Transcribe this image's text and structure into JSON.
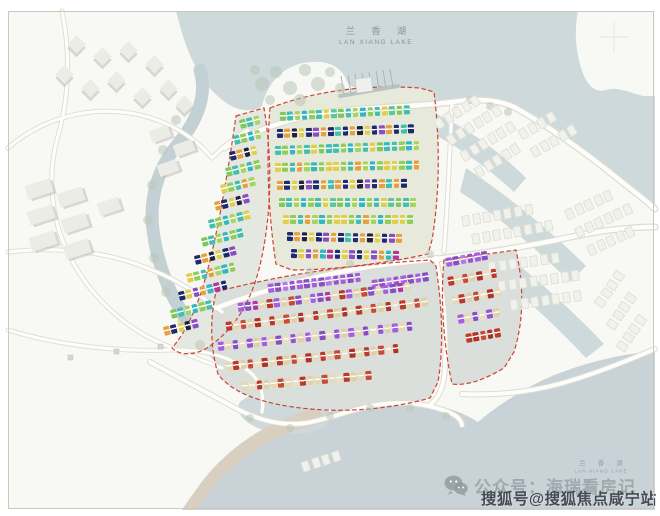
{
  "labels": {
    "lake_top": {
      "zh": "兰 香 湖",
      "en": "LAN XIANG LAKE"
    },
    "lake_bottom": {
      "zh": "兰 香 湖",
      "en": "LAN XIANG LAKE"
    }
  },
  "watermarks": {
    "wechat": {
      "icon": "wechat-icon",
      "text": "公众号：海瑞看房记"
    },
    "sohu": {
      "text": "搜狐号@搜狐焦点咸宁站"
    }
  },
  "colors": {
    "water": "#cdd9db",
    "water_deep": "#c9d2d7",
    "land": "#f8f8f4",
    "canal": "#c3d1d4",
    "sand": "#d9cfc0",
    "boundary": "#cc4434",
    "road": "#fdfdfa",
    "road_edge": "#dedcd4",
    "ground_a": "#e4e8e0",
    "ground_b": "#e7e9da",
    "ground_c": "#dadfdc",
    "ghost": "#f2f2ec"
  },
  "map": {
    "palettes": {
      "gt": [
        "#7dc95e",
        "#43c0ad",
        "#a5d55f",
        "#2fb7c4",
        "#8fce58",
        "#43c0ad",
        "#e0cf4e",
        "#5cc79a"
      ],
      "gt2": [
        "#43c0ad",
        "#8fce58",
        "#2fb7c4",
        "#a5d55f",
        "#43c0ad",
        "#e0cf4e",
        "#7dc95e",
        "#39bdb9"
      ],
      "gty": [
        "#e0cf4e",
        "#8fce58",
        "#43c0ad",
        "#e89f3d",
        "#a5d55f",
        "#2fb7c4",
        "#8fce58",
        "#e0cf4e"
      ],
      "dk1": [
        "#1e2a6e",
        "#e89f3d",
        "#23203a",
        "#e0cf4e",
        "#1e2a6e",
        "#8a4ec2",
        "#e89f3d",
        "#1e2a6e",
        "#43c0ad"
      ],
      "dk2": [
        "#e89f3d",
        "#1e2a6e",
        "#e0cf4e",
        "#23203a",
        "#8a4ec2",
        "#1e2a6e",
        "#e89f3d",
        "#43c0ad"
      ],
      "mix": [
        "#1e2a6e",
        "#e0cf4e",
        "#8a4ec2",
        "#e89f3d",
        "#2fb7c4",
        "#b0379d",
        "#1e2a6e",
        "#e0cf4e",
        "#8a4ec2"
      ],
      "pu": [
        "#a55ede",
        "#8a4ec2",
        "#b877e6",
        "#9a52d2",
        "#a55ede",
        "#8a4ec2"
      ],
      "rc": [
        "#bd3a2a",
        "#e6d9b2",
        "#c94b33",
        "#e0d0a4",
        "#b23325",
        "#eadfc0"
      ],
      "rc2": [
        "#e6d9b2",
        "#bd3a2a",
        "#e0d0a4",
        "#c94b33",
        "#eadfc0",
        "#b23325"
      ],
      "prc": [
        "#a55ede",
        "#8a4ec2",
        "#b0379d",
        "#e6d9b2",
        "#bd3a2a",
        "#a55ede",
        "#e0d0a4",
        "#c94b33",
        "#8a4ec2",
        "#e6d9b2"
      ],
      "pc2": [
        "#a55ede",
        "#e6d9b2",
        "#8a4ec2",
        "#eadfc0",
        "#9a52d2",
        "#e0d0a4"
      ],
      "cr2": [
        "#e6d9b2",
        "#eadfc0",
        "#bd3a2a",
        "#e0d0a4",
        "#e6d9b2",
        "#c94b33"
      ],
      "rd": [
        "#bd3a2a",
        "#b23325",
        "#c94b33",
        "#a93325"
      ]
    },
    "parcels": [
      {
        "name": "parcel-west",
        "rows": [
          [
            240,
            120,
            -14,
            3,
            "gt"
          ],
          [
            234,
            136,
            -14,
            4,
            "gt2"
          ],
          [
            230,
            152,
            -14,
            4,
            "dk1"
          ],
          [
            226,
            168,
            -14,
            5,
            "gt"
          ],
          [
            221,
            185,
            -14,
            5,
            "gty"
          ],
          [
            215,
            202,
            -14,
            5,
            "dk2"
          ],
          [
            209,
            220,
            -14,
            6,
            "gt2"
          ],
          [
            202,
            238,
            -14,
            6,
            "gt"
          ],
          [
            195,
            256,
            -14,
            6,
            "dk1"
          ],
          [
            187,
            274,
            -14,
            7,
            "gty"
          ],
          [
            179,
            292,
            -14,
            7,
            "mix"
          ],
          [
            171,
            310,
            -14,
            6,
            "gt"
          ],
          [
            164,
            327,
            -14,
            5,
            "dk2"
          ]
        ]
      },
      {
        "name": "parcel-north",
        "rows": [
          [
            280,
            112,
            -3,
            18,
            "gt"
          ],
          [
            277,
            129,
            -2,
            19,
            "dk1"
          ],
          [
            275,
            146,
            -2,
            20,
            "gt2"
          ],
          [
            275,
            163,
            -1,
            20,
            "gty"
          ],
          [
            277,
            181,
            -1,
            18,
            "dk2"
          ],
          [
            279,
            198,
            0,
            19,
            "gt"
          ],
          [
            283,
            215,
            0,
            18,
            "gty"
          ],
          [
            287,
            232,
            1,
            16,
            "dk1"
          ],
          [
            291,
            249,
            1,
            15,
            "mix"
          ]
        ]
      },
      {
        "name": "parcel-south",
        "rows": [
          [
            268,
            284,
            -7,
            13,
            "pu"
          ],
          [
            372,
            280,
            -8,
            8,
            "pu"
          ],
          [
            238,
            303,
            -7,
            24,
            "prc"
          ],
          [
            226,
            322,
            -7,
            28,
            "rc"
          ],
          [
            218,
            342,
            -6,
            27,
            "pc2"
          ],
          [
            226,
            362,
            -6,
            24,
            "rc2"
          ],
          [
            242,
            382,
            -5,
            18,
            "cr2"
          ]
        ]
      },
      {
        "name": "parcel-southeast",
        "rows": [
          [
            446,
            258,
            -10,
            6,
            "pu"
          ],
          [
            448,
            277,
            -10,
            7,
            "rc"
          ],
          [
            452,
            296,
            -10,
            7,
            "rc2"
          ],
          [
            458,
            315,
            -10,
            6,
            "pc2"
          ],
          [
            466,
            334,
            -10,
            5,
            "rd"
          ]
        ]
      }
    ],
    "ghost_rows": [
      [
        436,
        120,
        -32,
        5
      ],
      [
        448,
        136,
        -32,
        6
      ],
      [
        462,
        152,
        -32,
        6
      ],
      [
        476,
        168,
        -32,
        5
      ],
      [
        520,
        130,
        -30,
        4
      ],
      [
        532,
        148,
        -30,
        5
      ],
      [
        462,
        216,
        -10,
        7
      ],
      [
        472,
        234,
        -10,
        8
      ],
      [
        566,
        210,
        -25,
        5
      ],
      [
        576,
        228,
        -25,
        6
      ],
      [
        588,
        246,
        -25,
        5
      ],
      [
        488,
        262,
        -8,
        7
      ],
      [
        498,
        281,
        -8,
        8
      ],
      [
        510,
        300,
        -8,
        7
      ],
      [
        598,
        300,
        -55,
        4
      ],
      [
        610,
        322,
        -55,
        4
      ],
      [
        620,
        344,
        -55,
        4
      ],
      [
        302,
        462,
        -18,
        4
      ]
    ],
    "footprints": [
      [
        70,
        38,
        13,
        13,
        45
      ],
      [
        96,
        50,
        13,
        13,
        45
      ],
      [
        122,
        44,
        13,
        13,
        45
      ],
      [
        148,
        58,
        13,
        13,
        45
      ],
      [
        58,
        68,
        13,
        13,
        45
      ],
      [
        84,
        82,
        13,
        13,
        45
      ],
      [
        110,
        74,
        13,
        13,
        45
      ],
      [
        136,
        90,
        13,
        13,
        45
      ],
      [
        162,
        82,
        13,
        13,
        45
      ],
      [
        178,
        98,
        13,
        13,
        45
      ],
      [
        26,
        182,
        26,
        14,
        -18
      ],
      [
        58,
        190,
        26,
        14,
        -18
      ],
      [
        28,
        208,
        26,
        14,
        -18
      ],
      [
        62,
        216,
        26,
        14,
        -18
      ],
      [
        30,
        234,
        26,
        14,
        -18
      ],
      [
        64,
        242,
        26,
        14,
        -18
      ],
      [
        98,
        200,
        22,
        13,
        -18
      ],
      [
        150,
        128,
        20,
        12,
        -20
      ],
      [
        174,
        142,
        20,
        12,
        -20
      ],
      [
        158,
        162,
        20,
        12,
        -20
      ]
    ],
    "trees": [
      [
        262,
        84,
        7
      ],
      [
        276,
        72,
        6
      ],
      [
        290,
        88,
        7
      ],
      [
        305,
        70,
        6
      ],
      [
        318,
        84,
        7
      ],
      [
        300,
        100,
        6
      ],
      [
        330,
        72,
        5
      ],
      [
        270,
        100,
        5
      ],
      [
        340,
        88,
        5
      ],
      [
        255,
        70,
        5
      ],
      [
        176,
        120,
        5
      ],
      [
        163,
        150,
        5
      ],
      [
        152,
        185,
        5
      ],
      [
        148,
        220,
        5
      ],
      [
        154,
        258,
        5
      ],
      [
        166,
        292,
        5
      ],
      [
        182,
        320,
        5
      ],
      [
        200,
        345,
        5
      ],
      [
        310,
        272,
        4
      ],
      [
        350,
        264,
        4
      ],
      [
        390,
        258,
        4
      ],
      [
        430,
        254,
        4
      ],
      [
        250,
        418,
        4
      ],
      [
        290,
        428,
        4
      ],
      [
        330,
        416,
        4
      ],
      [
        370,
        408,
        4
      ],
      [
        410,
        408,
        4
      ],
      [
        446,
        416,
        4
      ],
      [
        470,
        100,
        4
      ],
      [
        490,
        106,
        4
      ],
      [
        508,
        112,
        4
      ]
    ]
  }
}
